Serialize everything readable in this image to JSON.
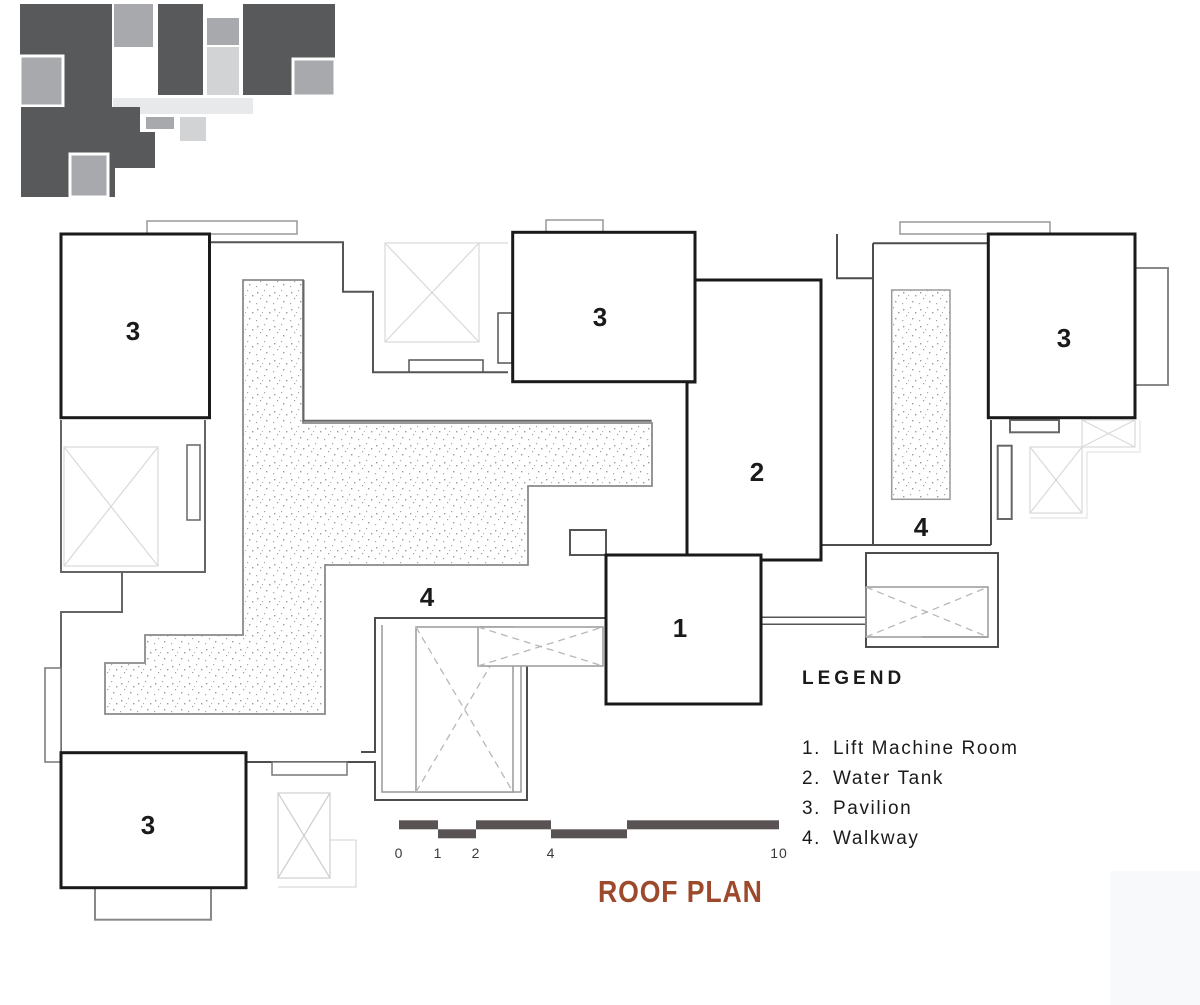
{
  "title": {
    "text": "ROOF PLAN",
    "color": "#9c4a2b"
  },
  "legend": {
    "heading": "LEGEND",
    "items": [
      {
        "num": "1.",
        "label": "Lift Machine Room"
      },
      {
        "num": "2.",
        "label": "Water Tank"
      },
      {
        "num": "3.",
        "label": "Pavilion"
      },
      {
        "num": "4.",
        "label": "Walkway"
      }
    ]
  },
  "plan_labels": {
    "pavilion_top_left": "3",
    "pavilion_top_middle": "3",
    "pavilion_top_right": "3",
    "pavilion_bottom_left": "3",
    "water_tank": "2",
    "lift_machine_room": "1",
    "walkway_left": "4",
    "walkway_right": "4"
  },
  "scale_bar": {
    "labels": [
      "0",
      "1",
      "2",
      "4",
      "10"
    ]
  },
  "colors": {
    "wall_bold": "#1a1a1a",
    "wall_dark": "#4d4d4d",
    "wall_mid": "#8a8a8a",
    "line_light": "#d9d9d9",
    "scale_bar": "#5a5353",
    "title": "#9c4a2b",
    "thumb_dark": "#58595b",
    "thumb_mid": "#a7a9ac",
    "thumb_light": "#d1d3d4",
    "thumb_pale": "#e8e9ea"
  }
}
